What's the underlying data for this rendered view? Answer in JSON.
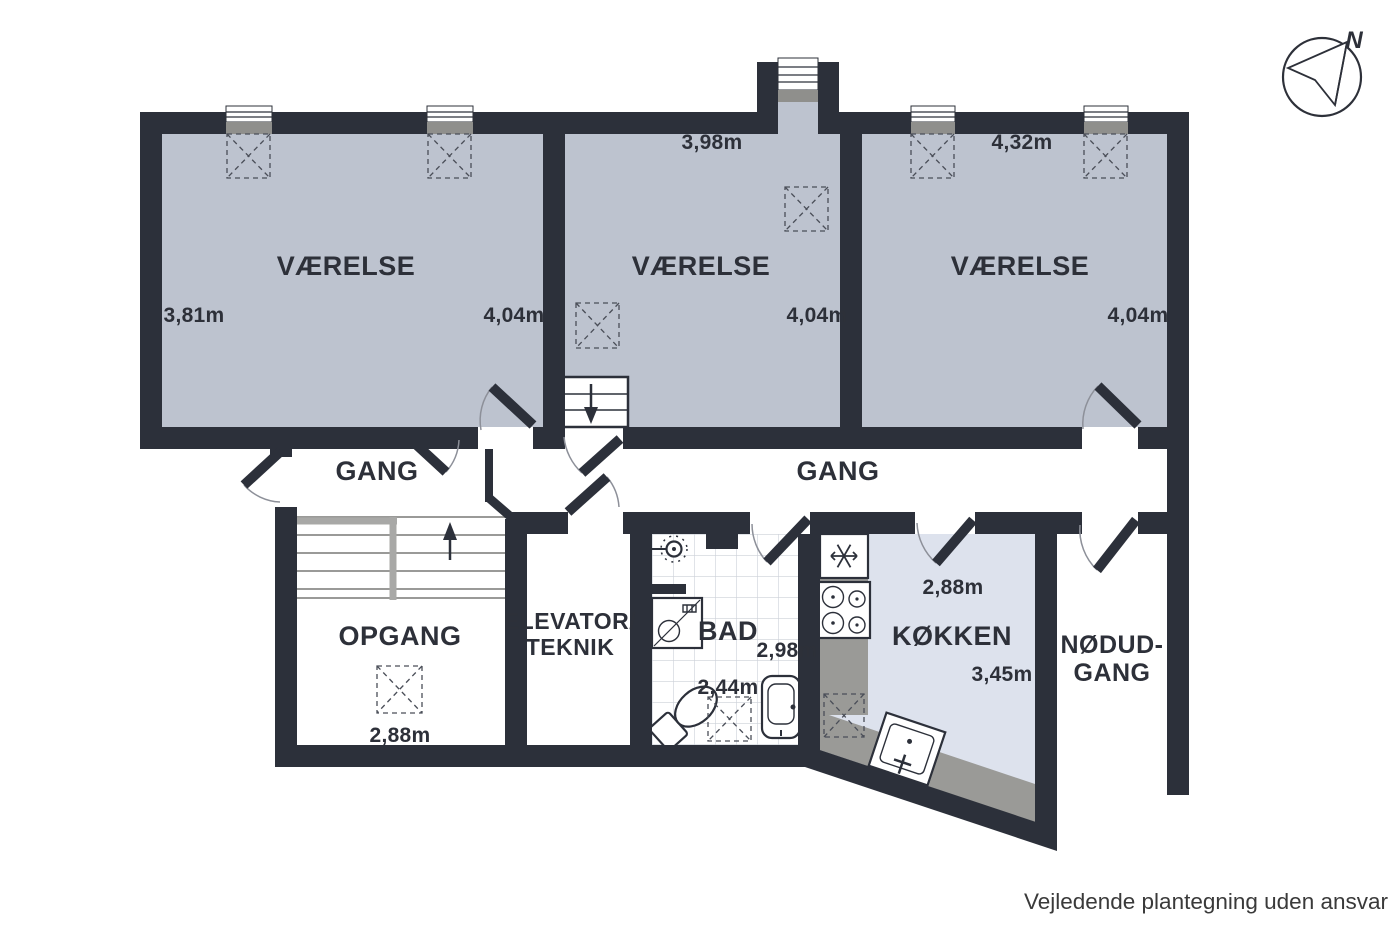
{
  "meta": {
    "disclaimer": "Vejledende plantegning uden ansvar",
    "compass_label": "N"
  },
  "colors": {
    "wall": "#2c303a",
    "room_fill": "#bdc3cf",
    "kitchen_fill": "#dde2ed",
    "counter": "#9a9a97",
    "window_sill": "#8f8f8c",
    "tile_line": "#ccd0d8",
    "text": "#2d3039",
    "door_arc": "#8d9099",
    "handrail": "#a8a8a6"
  },
  "icons": {
    "compass": "compass-rose",
    "fridge": "snowflake",
    "stove": "four-burners",
    "stairs_up": "arrow-up",
    "stairs_down": "arrow-down",
    "shower": "shower-head",
    "washing_machine": "washer-drum",
    "toilet": "toilet",
    "sink": "sink-basin",
    "wardrobe": "dashed-x-box"
  },
  "rooms": {
    "vaerelse_left": {
      "label": "VÆRELSE",
      "dim_left": "3,81m",
      "dim_right": "4,04m"
    },
    "vaerelse_middle": {
      "label": "VÆRELSE",
      "dim_top": "3,98m",
      "dim_right": "4,04m"
    },
    "vaerelse_right": {
      "label": "VÆRELSE",
      "dim_top": "4,32m",
      "dim_right": "4,04m"
    },
    "gang_left": {
      "label": "GANG"
    },
    "gang_right": {
      "label": "GANG"
    },
    "opgang": {
      "label": "OPGANG",
      "dim": "2,88m"
    },
    "elevator": {
      "label_line1": "ELEVATOR/",
      "label_line2": "TEKNIK"
    },
    "bad": {
      "label": "BAD",
      "dim_height": "2,98m",
      "dim_width": "2,44m"
    },
    "koekken": {
      "label": "KØKKEN",
      "dim_top": "2,88m",
      "dim_depth": "3,45m"
    },
    "noedudgang": {
      "label_line1": "NØDUD-",
      "label_line2": "GANG"
    }
  }
}
